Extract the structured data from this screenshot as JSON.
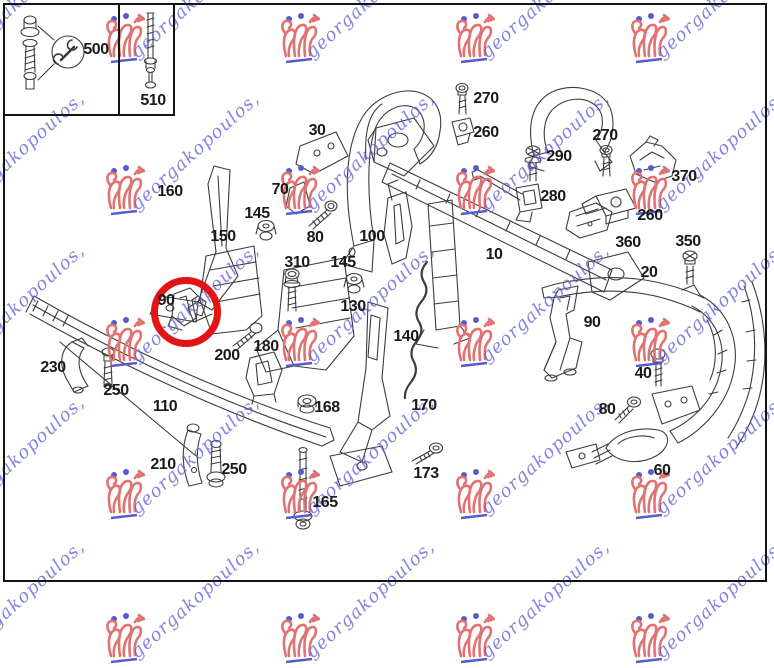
{
  "watermark": {
    "text": "georgakopoulos,",
    "text_color": "rgba(98,98,214,0.78)",
    "logo_color": "#e07272",
    "accent_color": "#5a5ad0",
    "grid_columns": [
      -50,
      125,
      300,
      475,
      650
    ],
    "grid_rows": [
      40,
      192,
      344,
      496,
      640
    ]
  },
  "highlight": {
    "circled_part": "90",
    "color": "#e31414",
    "cx": 186,
    "cy": 312,
    "diameter": 70,
    "stroke": 7
  },
  "inset": {
    "tool_icon": "wrench-icon",
    "boxes": [
      {
        "part": "500"
      },
      {
        "part": "510"
      }
    ]
  },
  "part_labels": [
    {
      "text": "500",
      "x": 96,
      "y": 50
    },
    {
      "text": "510",
      "x": 153,
      "y": 101
    },
    {
      "text": "30",
      "x": 317,
      "y": 131
    },
    {
      "text": "270",
      "x": 486,
      "y": 99
    },
    {
      "text": "260",
      "x": 486,
      "y": 133
    },
    {
      "text": "270",
      "x": 605,
      "y": 136
    },
    {
      "text": "290",
      "x": 559,
      "y": 157
    },
    {
      "text": "370",
      "x": 684,
      "y": 177
    },
    {
      "text": "280",
      "x": 553,
      "y": 197
    },
    {
      "text": "260",
      "x": 650,
      "y": 216
    },
    {
      "text": "360",
      "x": 628,
      "y": 243
    },
    {
      "text": "350",
      "x": 688,
      "y": 242
    },
    {
      "text": "160",
      "x": 170,
      "y": 192
    },
    {
      "text": "70",
      "x": 280,
      "y": 190
    },
    {
      "text": "145",
      "x": 257,
      "y": 214
    },
    {
      "text": "150",
      "x": 223,
      "y": 237
    },
    {
      "text": "80",
      "x": 315,
      "y": 238
    },
    {
      "text": "100",
      "x": 372,
      "y": 237
    },
    {
      "text": "10",
      "x": 494,
      "y": 255
    },
    {
      "text": "20",
      "x": 649,
      "y": 273
    },
    {
      "text": "310",
      "x": 297,
      "y": 263
    },
    {
      "text": "145",
      "x": 343,
      "y": 263
    },
    {
      "text": "130",
      "x": 353,
      "y": 307
    },
    {
      "text": "90",
      "x": 166,
      "y": 301
    },
    {
      "text": "140",
      "x": 406,
      "y": 337
    },
    {
      "text": "90",
      "x": 592,
      "y": 323
    },
    {
      "text": "200",
      "x": 227,
      "y": 356
    },
    {
      "text": "180",
      "x": 266,
      "y": 347
    },
    {
      "text": "230",
      "x": 53,
      "y": 368
    },
    {
      "text": "250",
      "x": 116,
      "y": 391
    },
    {
      "text": "40",
      "x": 643,
      "y": 374
    },
    {
      "text": "110",
      "x": 165,
      "y": 407
    },
    {
      "text": "168",
      "x": 327,
      "y": 408
    },
    {
      "text": "170",
      "x": 424,
      "y": 406
    },
    {
      "text": "80",
      "x": 607,
      "y": 410
    },
    {
      "text": "173",
      "x": 426,
      "y": 474
    },
    {
      "text": "210",
      "x": 163,
      "y": 465
    },
    {
      "text": "250",
      "x": 234,
      "y": 470
    },
    {
      "text": "165",
      "x": 325,
      "y": 503
    },
    {
      "text": "60",
      "x": 662,
      "y": 471
    }
  ]
}
